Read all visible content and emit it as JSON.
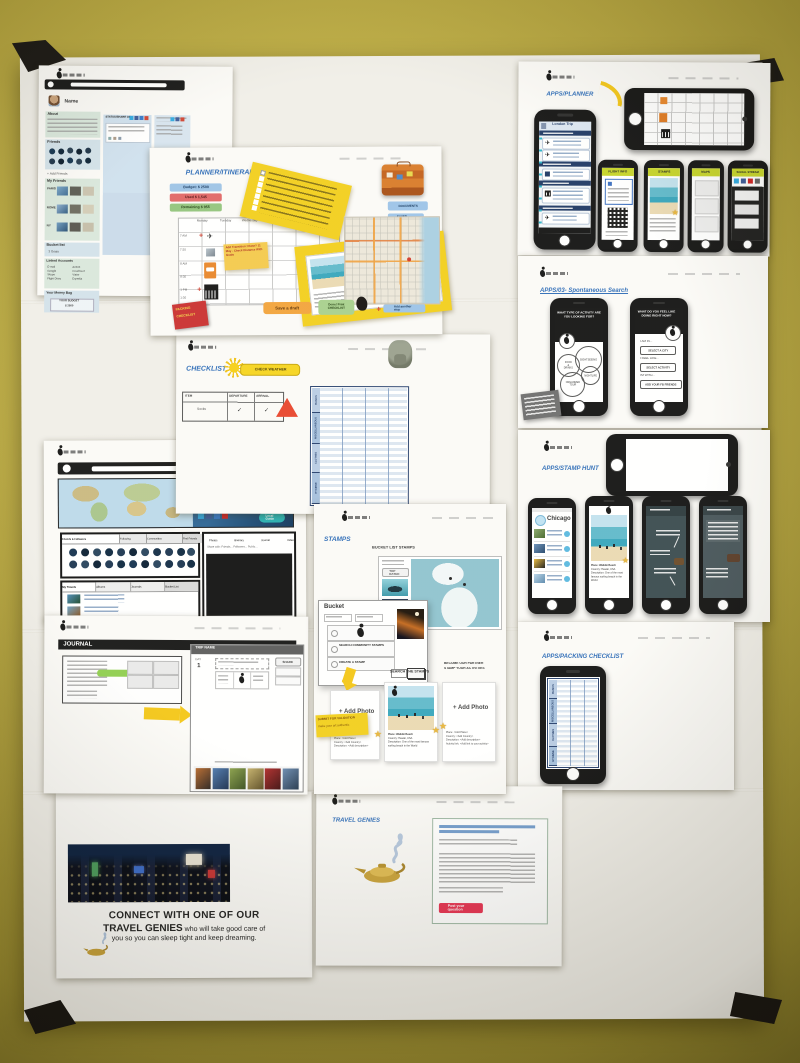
{
  "colors": {
    "wall": "#b3a23c",
    "accent_blue": "#2f6db8",
    "sticky_yellow": "#f2cf1d",
    "budget_blue": "#9dc3e6",
    "budget_red": "#e06666",
    "budget_green": "#93c47d",
    "phone_tab_green": "#c6d429",
    "star_gold": "#e8b53a",
    "button_red": "#e73352"
  },
  "pages": {
    "profile1": {
      "name_label": "Name",
      "about_title": "About",
      "friends_title": "Friends",
      "add_friends_link": "+ Add Friends",
      "my_friends_title": "My Friends",
      "friend_groups": [
        "PARIS",
        "ROME",
        "NY"
      ],
      "bucket_title": "Bucket list",
      "bucket_line": "3 Goals",
      "linked_title": "Linked Accounts",
      "linked_accounts_left": [
        "E-mail",
        "Google",
        "Skype",
        "Flight Diary"
      ],
      "linked_accounts_right": [
        "Airbnb",
        "Couchsurf",
        "Viator",
        "Expedia"
      ],
      "money_title": "Your Money Bag",
      "budget_box_line1": "YOUR BUDGET",
      "budget_box_line2": "$ 2500",
      "status_title": "STATUS/SHARE ON"
    },
    "planner": {
      "title": "PLANNER/ITINERARY",
      "budget_pills": [
        "Budget: $ 2500",
        "Used $ 1,545",
        "Remaining $ 955"
      ],
      "days": [
        "Monday",
        "Tuesday",
        "Wednesday",
        "Thursday",
        "Friday",
        "Saturday"
      ],
      "times": [
        "7 AM",
        "7:30",
        "8 AM",
        "8:30",
        "1 PM",
        "1:30"
      ],
      "transition_note": "Add Transition: Plane? 11 May - Check Distance With Goals",
      "documents_button": "DOCUMENTS",
      "saved_maps_button": "SAVED MAPS",
      "packing_sticker_line1": "PACKING",
      "packing_sticker_line2": "CHECKLIST",
      "save_draft_button": "Save a draft",
      "done_button": "Done! Print CHECKLIST",
      "add_stop_plus": "+",
      "add_stop_button": "Add another stop"
    },
    "checklist": {
      "title": "CHECKLIST",
      "check_weather_button": "CHECK WEATHER",
      "table_headers": [
        "ITEM",
        "DEPARTURE",
        "ARRIVAL"
      ],
      "row_item": "Socks",
      "row_departure": "✓",
      "row_arrival": "✓",
      "packing_sections": [
        "BASICS",
        "MISCELLANEOUS",
        "CLOTHES",
        "HYGIENE"
      ]
    },
    "profile2": {
      "user_name": "Ivona Gruscha",
      "about_label": "About",
      "badge": "Local Guide",
      "social_tabs": [
        "Friends & Followers",
        "Following",
        "Communities",
        "Find Friends"
      ],
      "share_items": [
        "Photos",
        "Itinerary",
        "Journal",
        "Video"
      ],
      "share_with_line": "Share with:  Friends...  Followers...  Public...",
      "travel_tabs": [
        "My Travels",
        "Albums",
        "Journals",
        "Bucket List"
      ]
    },
    "journal": {
      "title": "JOURNAL",
      "panel_header": "TRIP NAME",
      "day_label": "DAY",
      "day_value": "1",
      "share_button": "SHARE"
    },
    "stamps": {
      "title": "STAMPS",
      "bucket_heading": "BUCKET LIST STAMPS",
      "top_rated_button": "TOP RATED",
      "popup_title": "Bucket",
      "popup_option_search": "SEARCH COMMUNITY STAMPS",
      "popup_option_create": "CREATE A STAMP",
      "search_heading": "SEARCH THE STAMPS",
      "partner_heading_line1": "BECOME OUR PARTNER",
      "partner_heading_line2": "STAMP YOUR ACTIVITIES",
      "add_photo_label": "+ Add Photo",
      "validation_note_line1": "SUBMIT FOR VALIDATION",
      "validation_note_line2": "make your art authentic",
      "empty_fields": [
        "Place: <Add Place>",
        "Country: <Add Country>",
        "Description: <Add description>"
      ],
      "stamp_fields": [
        "Place: Waikiki Beach",
        "Country: Hawaii, USA",
        "Description: One of the most famous surfing beach in the World"
      ],
      "partner_fields": [
        "Place: <Add Place>",
        "Country: <Add Country>",
        "Description: <Add description>",
        "Activity link: <Add link to your activity>"
      ]
    },
    "apps_planner": {
      "title": "APPS/PLANNER",
      "trip_header": "London Trip",
      "phone_tabs": [
        "FLIGHT INFO",
        "STAMPS",
        "MAPS",
        "SOCIAL STREAM"
      ]
    },
    "apps_search": {
      "title": "APPS/03- Spontaneous Search",
      "question_left": "WHAT TYPE OF ACTIVITY ARE YOU LOOKING FOR?",
      "question_right": "WHAT DO YOU FEEL LIKE DOING RIGHT NOW?",
      "activity_circles": [
        "SIGHTSEEING",
        "FOOD & DRINKS",
        "NIGHTLIFE",
        "ORGANIZED TOUR"
      ],
      "form_labels": [
        "I AM IN...",
        "I FEEL LIKE...",
        "I'M WITH..."
      ],
      "form_buttons": [
        "SELECT A CITY",
        "SELECT ACTIVITY",
        "ADD YOUR FB FRIENDS"
      ]
    },
    "apps_stamphunt": {
      "title": "APPS/STAMP HUNT",
      "city_header": "Chicago",
      "stamp_fields": [
        "Place: Waikiki Beach",
        "Country: Hawaii, USA",
        "Description: One of the most famous surfing beach in the World"
      ]
    },
    "apps_packing": {
      "title": "APPS/PACKING CHECKLIST"
    },
    "travel_genies": {
      "title": "TRAVEL GENIES",
      "post_button": "Post your question"
    },
    "connect": {
      "line1": "CONNECT WITH ONE OF OUR",
      "line2_strong": "TRAVEL GENIES",
      "line2_rest": " who will take good care of",
      "line3": "you so you can sleep tight and keep dreaming."
    }
  }
}
